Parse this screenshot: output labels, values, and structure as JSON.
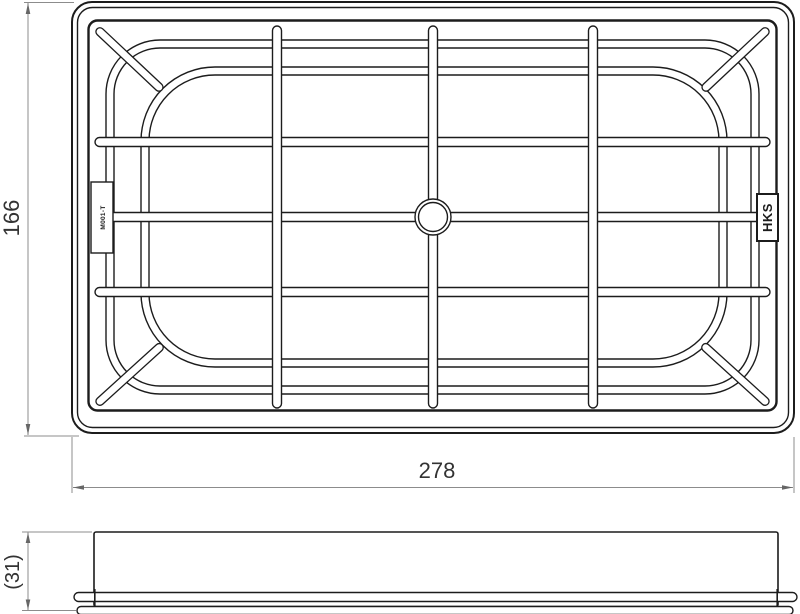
{
  "dimensions": {
    "width": "278",
    "height": "166",
    "thickness": "(31)"
  },
  "top_view": {
    "brand_label": "HKS",
    "part_tab_label": "M001-T"
  },
  "colors": {
    "line": "#1c1c1c",
    "dimension_line": "#8c8c8c",
    "text": "#333333",
    "background": "#ffffff"
  }
}
